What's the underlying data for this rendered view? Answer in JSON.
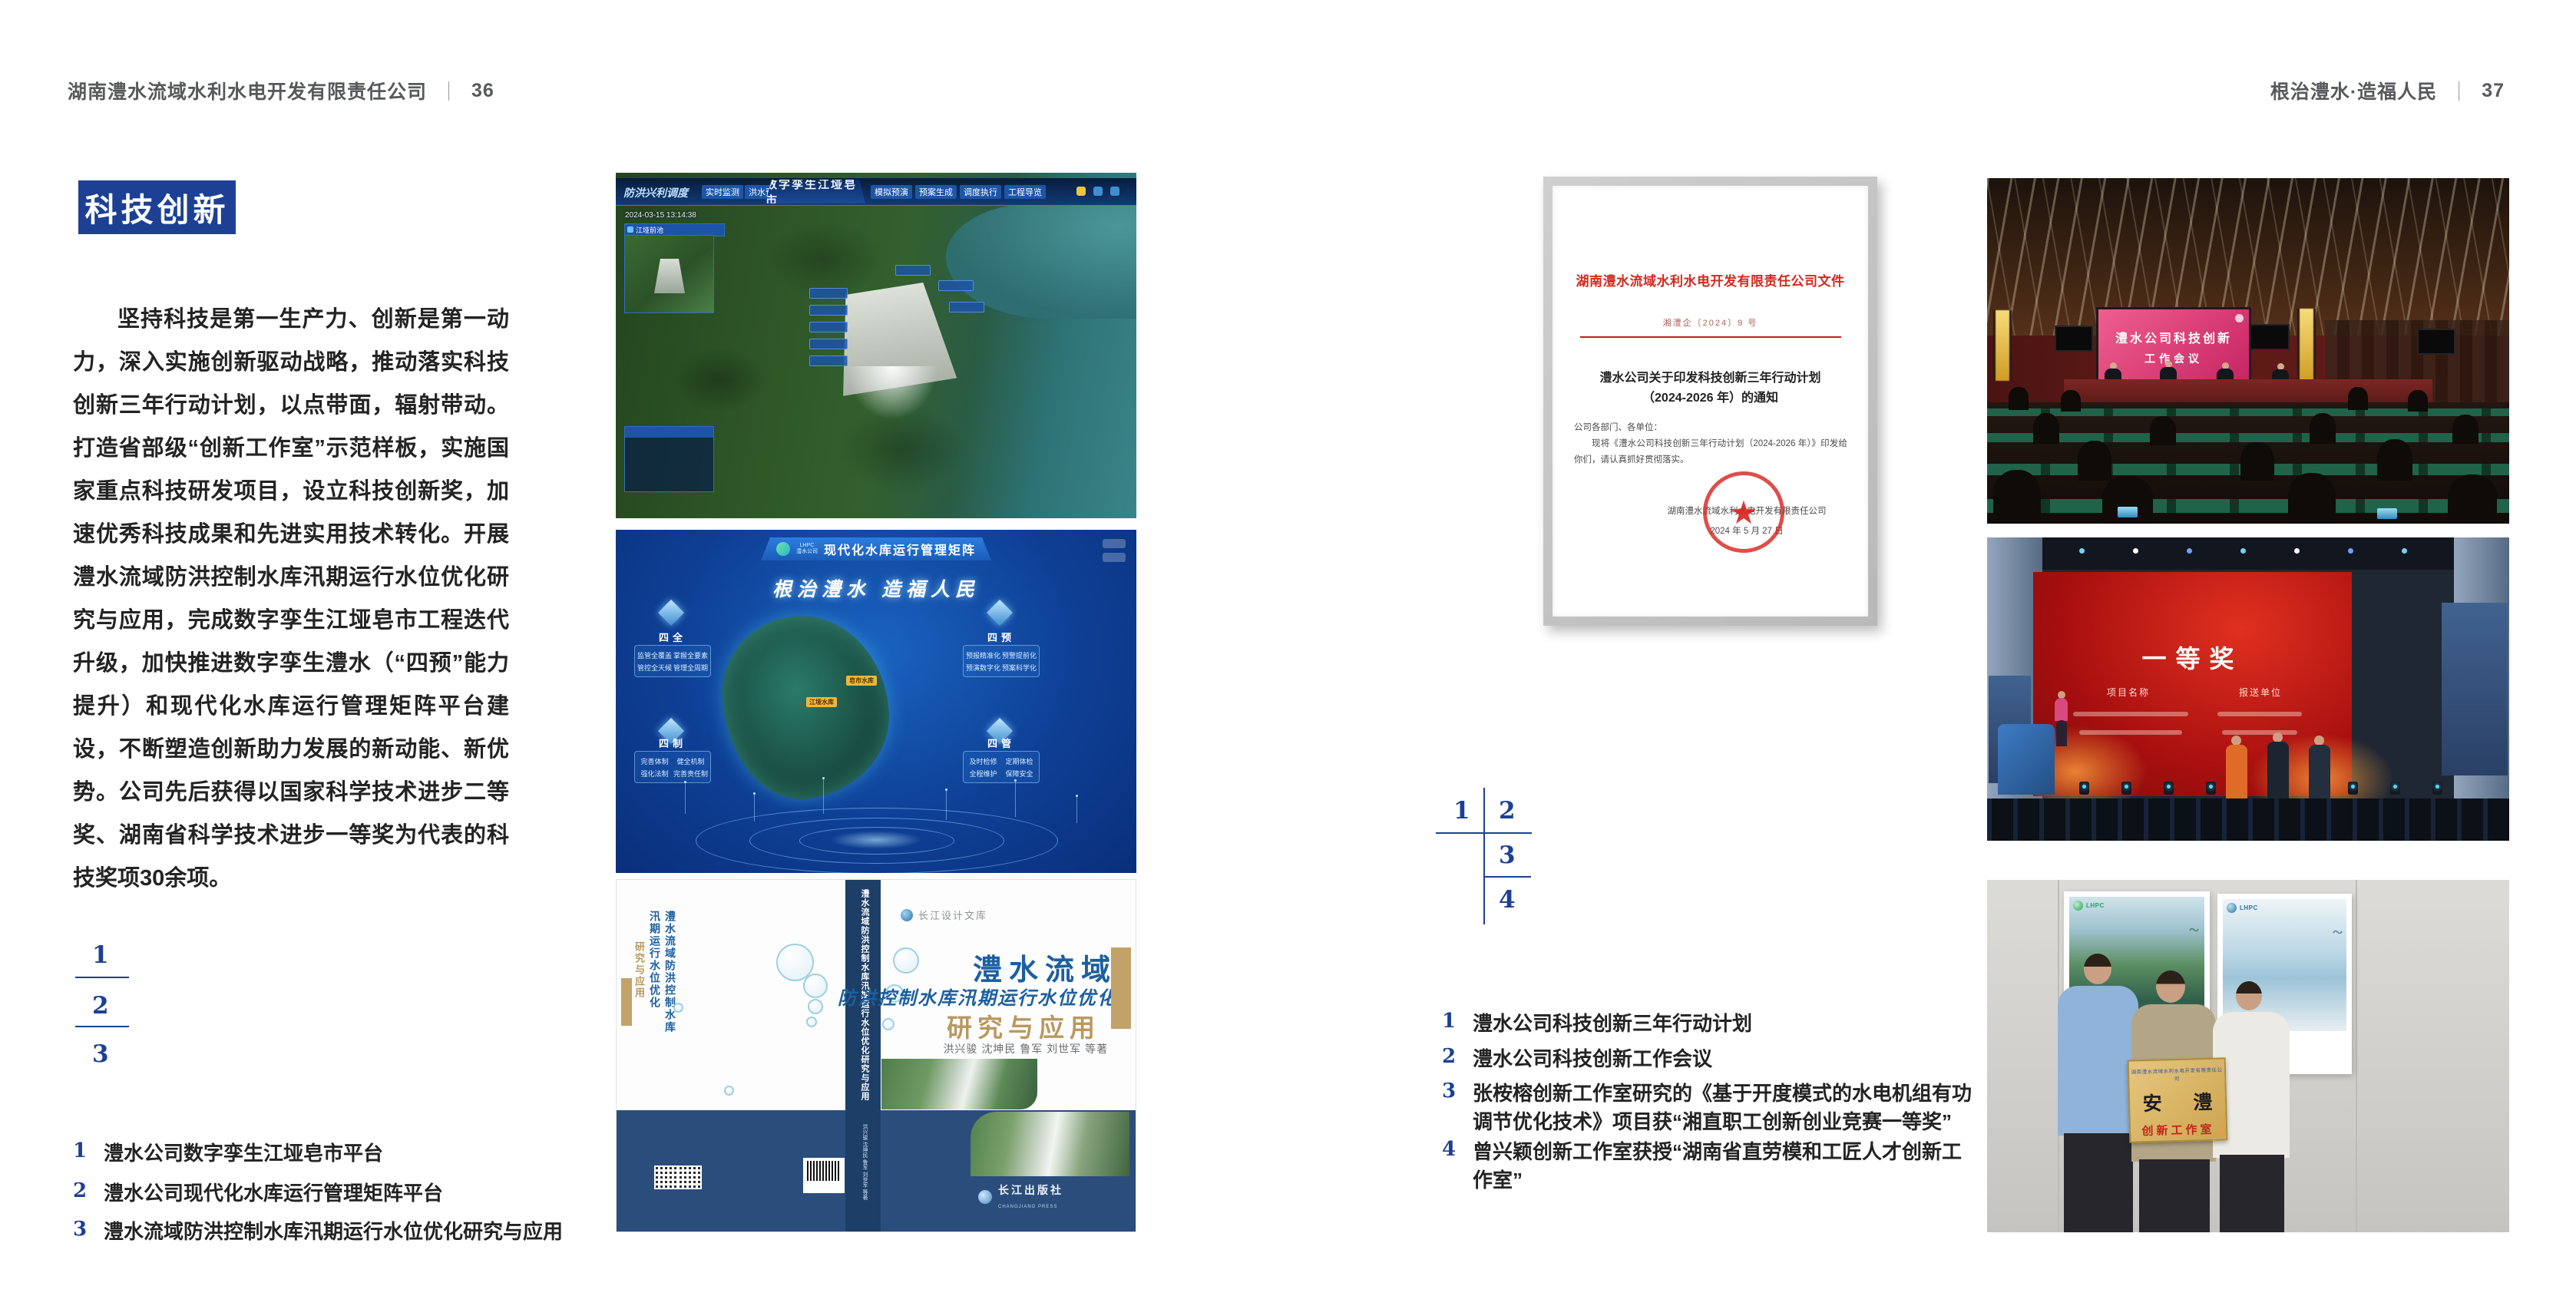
{
  "palette": {
    "accent_blue": "#1d4094",
    "doc_red": "#d3281e",
    "gold": "#d8b96a",
    "screen_pink": "#d6436e"
  },
  "left_page": {
    "header": {
      "company": "湖南澧水流域水利水电开发有限责任公司",
      "separator": "｜",
      "page_no": "36"
    },
    "badge": "科技创新",
    "paragraph": "坚持科技是第一生产力、创新是第一动力，深入实施创新驱动战略，推动落实科技创新三年行动计划，以点带面，辐射带动。打造省部级“创新工作室”示范样板，实施国家重点科技研发项目，设立科技创新奖，加速优秀科技成果和先进实用技术转化。开展澧水流域防洪控制水库汛期运行水位优化研究与应用，完成数字孪生江垭皂市工程迭代升级，加快推进数字孪生澧水（“四预”能力提升）和现代化水库运行管理矩阵平台建设，不断塑造创新助力发展的新动能、新优势。公司先后获得以国家科学技术进步二等奖、湖南省科学技术进步一等奖为代表的科技奖项30余项。",
    "index": [
      "1",
      "2",
      "3"
    ],
    "captions": [
      {
        "no": "1",
        "text": "澧水公司数字孪生江垭皂市平台"
      },
      {
        "no": "2",
        "text": "澧水公司现代化水库运行管理矩阵平台"
      },
      {
        "no": "3",
        "text": "澧水流域防洪控制水库汛期运行水位优化研究与应用"
      }
    ],
    "dam_ui": {
      "corner_label": "防洪兴利调度",
      "tabs_left": [
        "实时监测",
        "洪水预报",
        "防汛预警"
      ],
      "title": "数字孪生江垭皂市",
      "tabs_right": [
        "模拟预演",
        "预案生成",
        "调度执行",
        "工程导览"
      ],
      "timestamp": "2024-03-15 13:14:38",
      "panel_title": "江垭前池"
    },
    "matrix_ui": {
      "logo_line1": "LHPC",
      "logo_line2": "澧水公司",
      "title": "现代化水库运行管理矩阵",
      "slogan": "根治澧水 造福人民",
      "panels": [
        {
          "title": "四全",
          "items": [
            "监管全覆盖",
            "掌握全要素",
            "管控全天候",
            "管理全周期"
          ]
        },
        {
          "title": "四预",
          "items": [
            "预报精准化",
            "预警提前化",
            "预演数字化",
            "预案科学化"
          ]
        },
        {
          "title": "四制",
          "items": [
            "完善体制",
            "健全机制",
            "强化法制",
            "完善责任制"
          ]
        },
        {
          "title": "四管",
          "items": [
            "及时检修",
            "定期体检",
            "全程维护",
            "保障安全"
          ]
        }
      ],
      "map_labels": [
        "皂市水库",
        "江垭水库"
      ]
    },
    "book": {
      "series": "长江设计文库",
      "back_title": "澧水流域防洪控制水库汛期运行水位优化",
      "back_tail": "研究与应用",
      "title_main": "澧水流域",
      "title_sub": "防洪控制水库汛期运行水位优化",
      "title_tail": "研究与应用",
      "authors": "洪兴骏 沈坤民 鲁军 刘世军 等著",
      "spine_text": "澧水流域防洪控制水库汛期运行水位优化研究与应用",
      "spine_authors": "洪兴骏 沈坤民 鲁军 刘世军 等著",
      "publisher": "长江出版社",
      "publisher_en": "CHANGJIANG PRESS"
    }
  },
  "right_page": {
    "header": {
      "slogan": "根治澧水·造福人民",
      "separator": "｜",
      "page_no": "37"
    },
    "document": {
      "red_title": "湖南澧水流域水利水电开发有限责任公司文件",
      "doc_no": "湘澧企〔2024〕9 号",
      "subject_line1": "澧水公司关于印发科技创新三年行动计划",
      "subject_line2": "（2024-2026 年）的通知",
      "salutation": "公司各部门、各单位：",
      "body": "现将《澧水公司科技创新三年行动计划（2024-2026 年）》印发给你们，请认真抓好贯彻落实。",
      "signature": "湖南澧水流域水利水电开发有限责任公司",
      "date": "2024 年 5 月 27 日",
      "seal_star": "★"
    },
    "index": [
      "1",
      "2",
      "3",
      "4"
    ],
    "captions": [
      {
        "no": "1",
        "text": "澧水公司科技创新三年行动计划"
      },
      {
        "no": "2",
        "text": "澧水公司科技创新工作会议"
      },
      {
        "no": "3",
        "text": "张桉榕创新工作室研究的《基于开度模式的水电机组有功调节优化技术》项目获“湘直职工创新创业竞赛一等奖”"
      },
      {
        "no": "4",
        "text": "曾兴颖创新工作室获授“湖南省直劳模和工匠人才创新工作室”"
      }
    ],
    "meeting": {
      "screen_line1": "澧水公司科技创新",
      "screen_line2": "工作会议"
    },
    "award": {
      "title": "一等奖",
      "col_left": "项目名称",
      "col_right": "报送单位"
    },
    "group": {
      "plaque_org": "湖南澧水流域水利水电开发有限责任公司",
      "plaque_name": "安 澧",
      "plaque_title": "创新工作室",
      "poster_logo": "LHPC"
    }
  }
}
